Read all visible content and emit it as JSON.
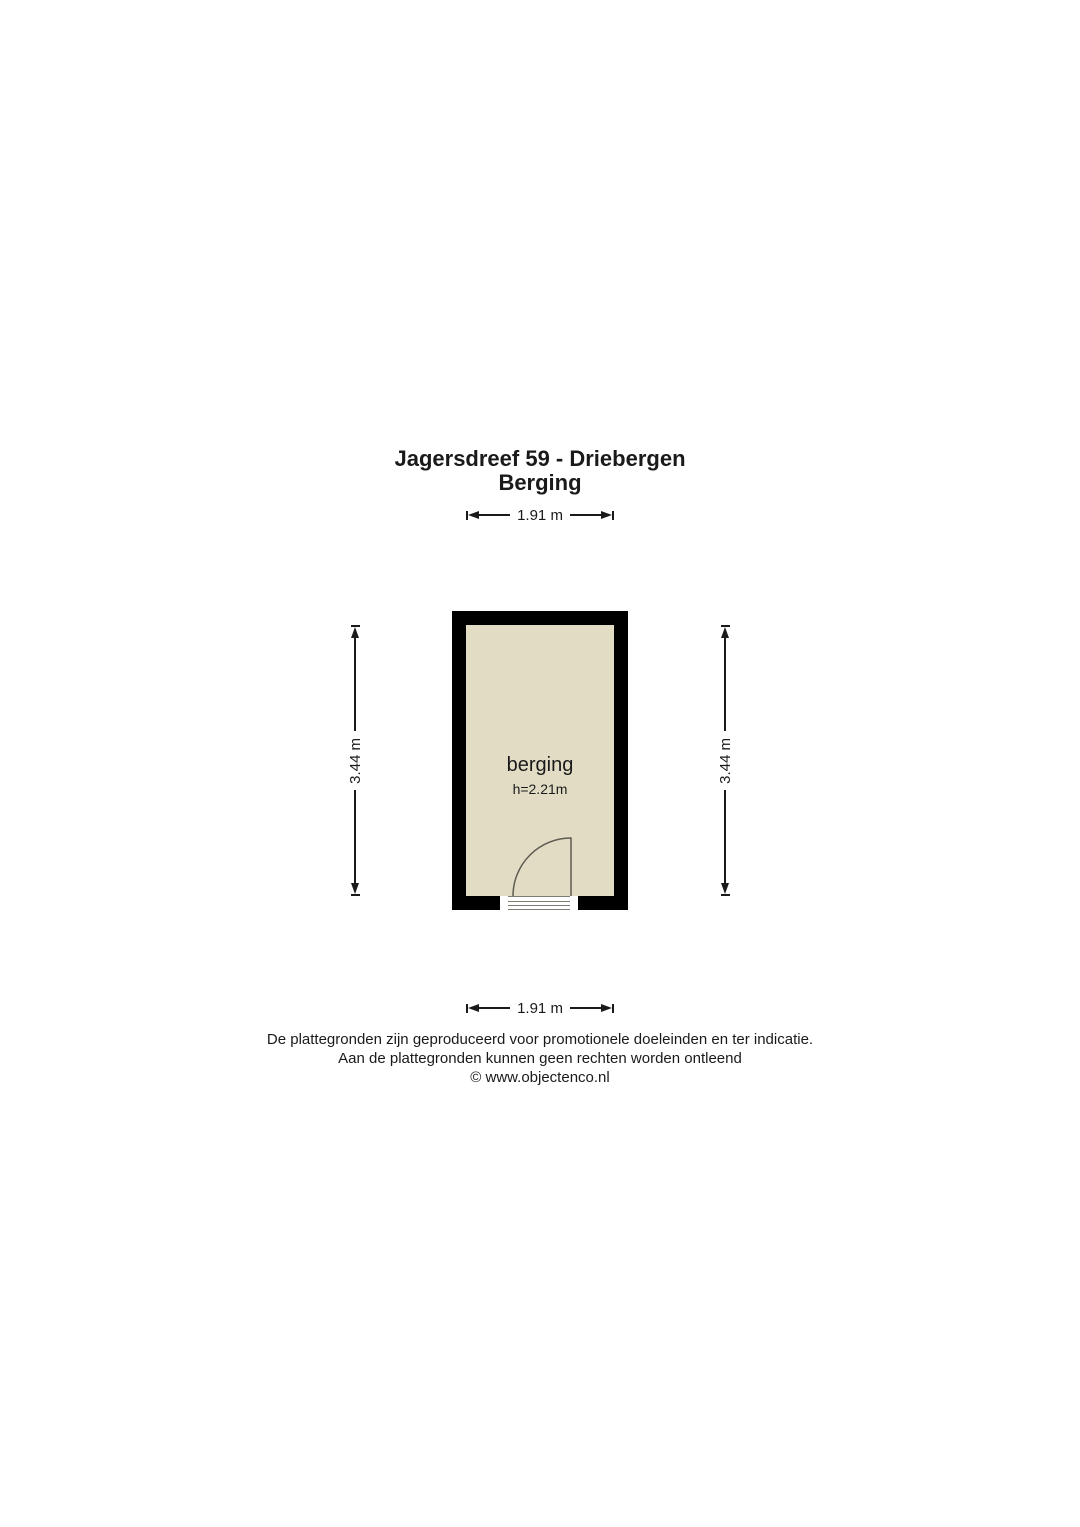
{
  "header": {
    "title_line1": "Jagersdreef 59 - Driebergen",
    "title_line2": "Berging"
  },
  "dimensions": {
    "top_width": "1.91 m",
    "bottom_width": "1.91 m",
    "left_height": "3.44 m",
    "right_height": "3.44 m"
  },
  "room": {
    "name": "berging",
    "ceiling_height": "h=2.21m"
  },
  "footer": {
    "line1": "De plattegronden zijn geproduceerd voor promotionele doeleinden en ter indicatie.",
    "line2": "Aan de plattegronden kunnen geen rechten worden ontleend",
    "line3": "© www.objectenco.nl"
  },
  "colors": {
    "wall": "#000000",
    "floor": "#e2dcc5",
    "door": "#5c5c50",
    "dim": "#1a1a1a"
  }
}
